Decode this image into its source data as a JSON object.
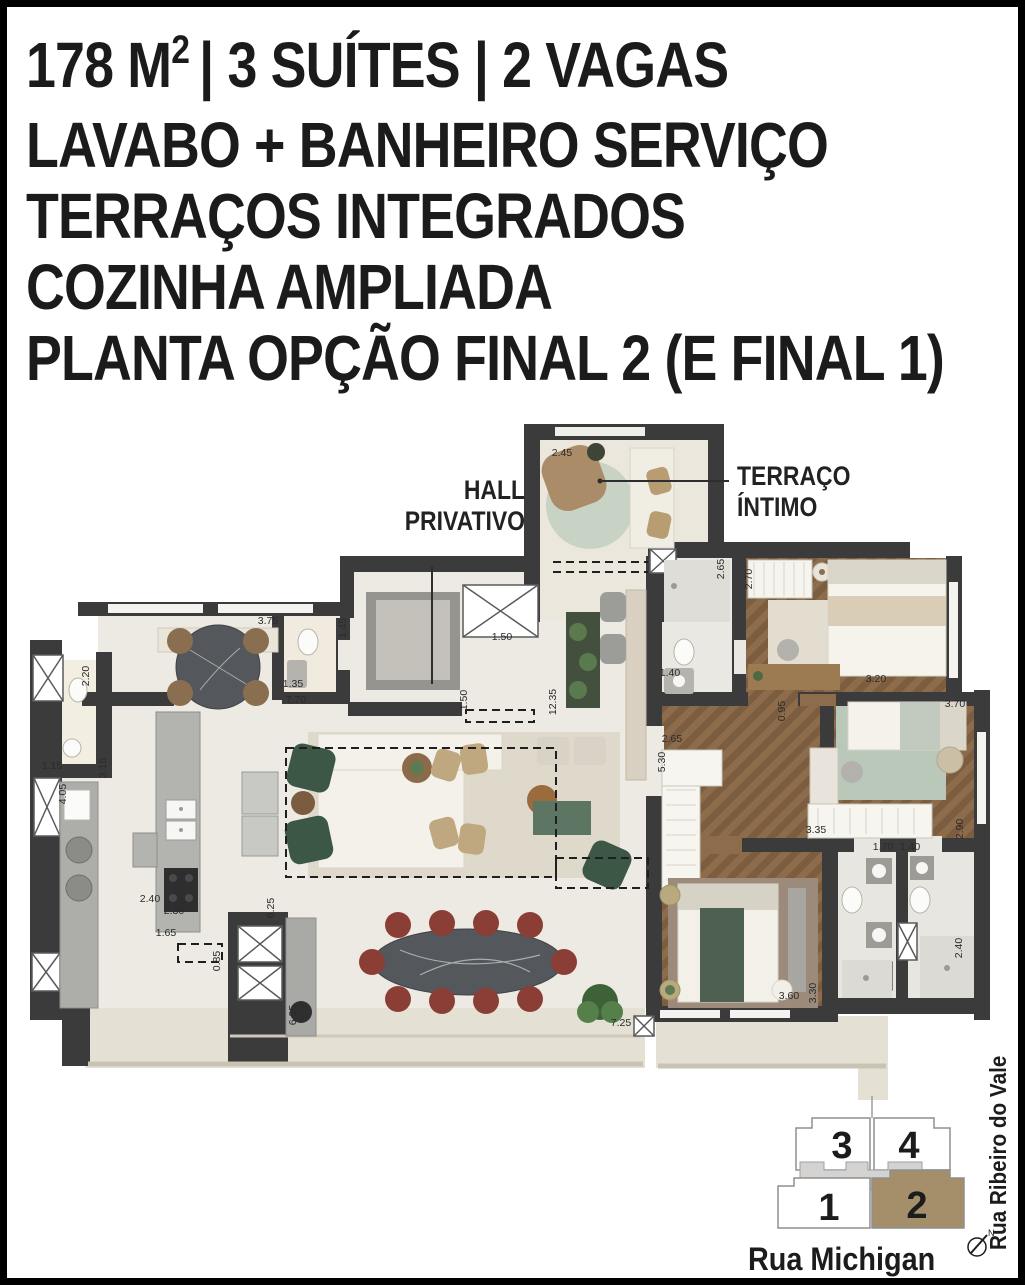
{
  "header": {
    "line1": {
      "prefix": "178 M",
      "sup": "2",
      "rest": "| 3 SUÍTES | 2 VAGAS"
    },
    "line2": "LAVABO + BANHEIRO SERVIÇO",
    "line3": "TERRAÇOS INTEGRADOS",
    "line4": "COZINHA AMPLIADA",
    "line5": "PLANTA OPÇÃO FINAL 2 (E FINAL 1)"
  },
  "plan": {
    "room_labels": {
      "hall": "HALL PRIVATIVO",
      "terraco": "TERRAÇO ÍNTIMO"
    },
    "dimensions": [
      {
        "v": "2.45",
        "x": 562,
        "y": 456,
        "r": 0
      },
      {
        "v": "1.50",
        "x": 502,
        "y": 640,
        "r": 0
      },
      {
        "v": "1.50",
        "x": 467,
        "y": 700,
        "r": 1
      },
      {
        "v": "12.35",
        "x": 556,
        "y": 702,
        "r": 1
      },
      {
        "v": "1.45",
        "x": 346,
        "y": 628,
        "r": 1
      },
      {
        "v": "1.35",
        "x": 293,
        "y": 687,
        "r": 0
      },
      {
        "v": "7.70",
        "x": 296,
        "y": 703,
        "r": 0
      },
      {
        "v": "3.75",
        "x": 268,
        "y": 624,
        "r": 0
      },
      {
        "v": "2.20",
        "x": 89,
        "y": 676,
        "r": 1
      },
      {
        "v": "1.15",
        "x": 52,
        "y": 769,
        "r": 0
      },
      {
        "v": "3.15",
        "x": 106,
        "y": 768,
        "r": 1
      },
      {
        "v": "4.05",
        "x": 66,
        "y": 794,
        "r": 1
      },
      {
        "v": "2.40",
        "x": 150,
        "y": 902,
        "r": 0
      },
      {
        "v": "2.30",
        "x": 174,
        "y": 914,
        "r": 0
      },
      {
        "v": "1.65",
        "x": 166,
        "y": 936,
        "r": 0
      },
      {
        "v": "0.85",
        "x": 220,
        "y": 961,
        "r": 1
      },
      {
        "v": "6.95",
        "x": 296,
        "y": 1015,
        "r": 1
      },
      {
        "v": "6.25",
        "x": 274,
        "y": 908,
        "r": 1
      },
      {
        "v": "7.25",
        "x": 621,
        "y": 1026,
        "r": 0
      },
      {
        "v": "2.65",
        "x": 724,
        "y": 569,
        "r": 1
      },
      {
        "v": "2.70",
        "x": 752,
        "y": 579,
        "r": 1
      },
      {
        "v": "1.40",
        "x": 670,
        "y": 676,
        "r": 0
      },
      {
        "v": "3.20",
        "x": 876,
        "y": 682,
        "r": 0
      },
      {
        "v": "0.95",
        "x": 785,
        "y": 711,
        "r": 1
      },
      {
        "v": "2.65",
        "x": 672,
        "y": 742,
        "r": 0
      },
      {
        "v": "5.30",
        "x": 665,
        "y": 762,
        "r": 1
      },
      {
        "v": "3.70",
        "x": 955,
        "y": 707,
        "r": 0
      },
      {
        "v": "2.90",
        "x": 963,
        "y": 829,
        "r": 1
      },
      {
        "v": "3.35",
        "x": 816,
        "y": 833,
        "r": 0
      },
      {
        "v": "1.70",
        "x": 883,
        "y": 850,
        "r": 0
      },
      {
        "v": "1.40",
        "x": 910,
        "y": 850,
        "r": 0
      },
      {
        "v": "2.40",
        "x": 962,
        "y": 948,
        "r": 1
      },
      {
        "v": "3.30",
        "x": 816,
        "y": 993,
        "r": 1
      },
      {
        "v": "3.60",
        "x": 789,
        "y": 999,
        "r": 0
      }
    ]
  },
  "keymap": {
    "units": [
      {
        "label": "3"
      },
      {
        "label": "4"
      },
      {
        "label": "1"
      },
      {
        "label": "2"
      }
    ],
    "streets": {
      "bottom": "Rua Michigan",
      "right": "Rua Ribeiro do Vale"
    },
    "north_label": "N",
    "highlight_color": "#a58e6a"
  },
  "colors": {
    "wall": "#3b3b3b",
    "floor": "#edeae3",
    "terrace_floor": "#e4e0d4",
    "wood": "#8d6c4b",
    "armchair_green": "#3d5747",
    "dining_chair_red": "#8b3e35",
    "marble_dark": "#54575b",
    "keymap_highlight": "#a58e6a"
  }
}
